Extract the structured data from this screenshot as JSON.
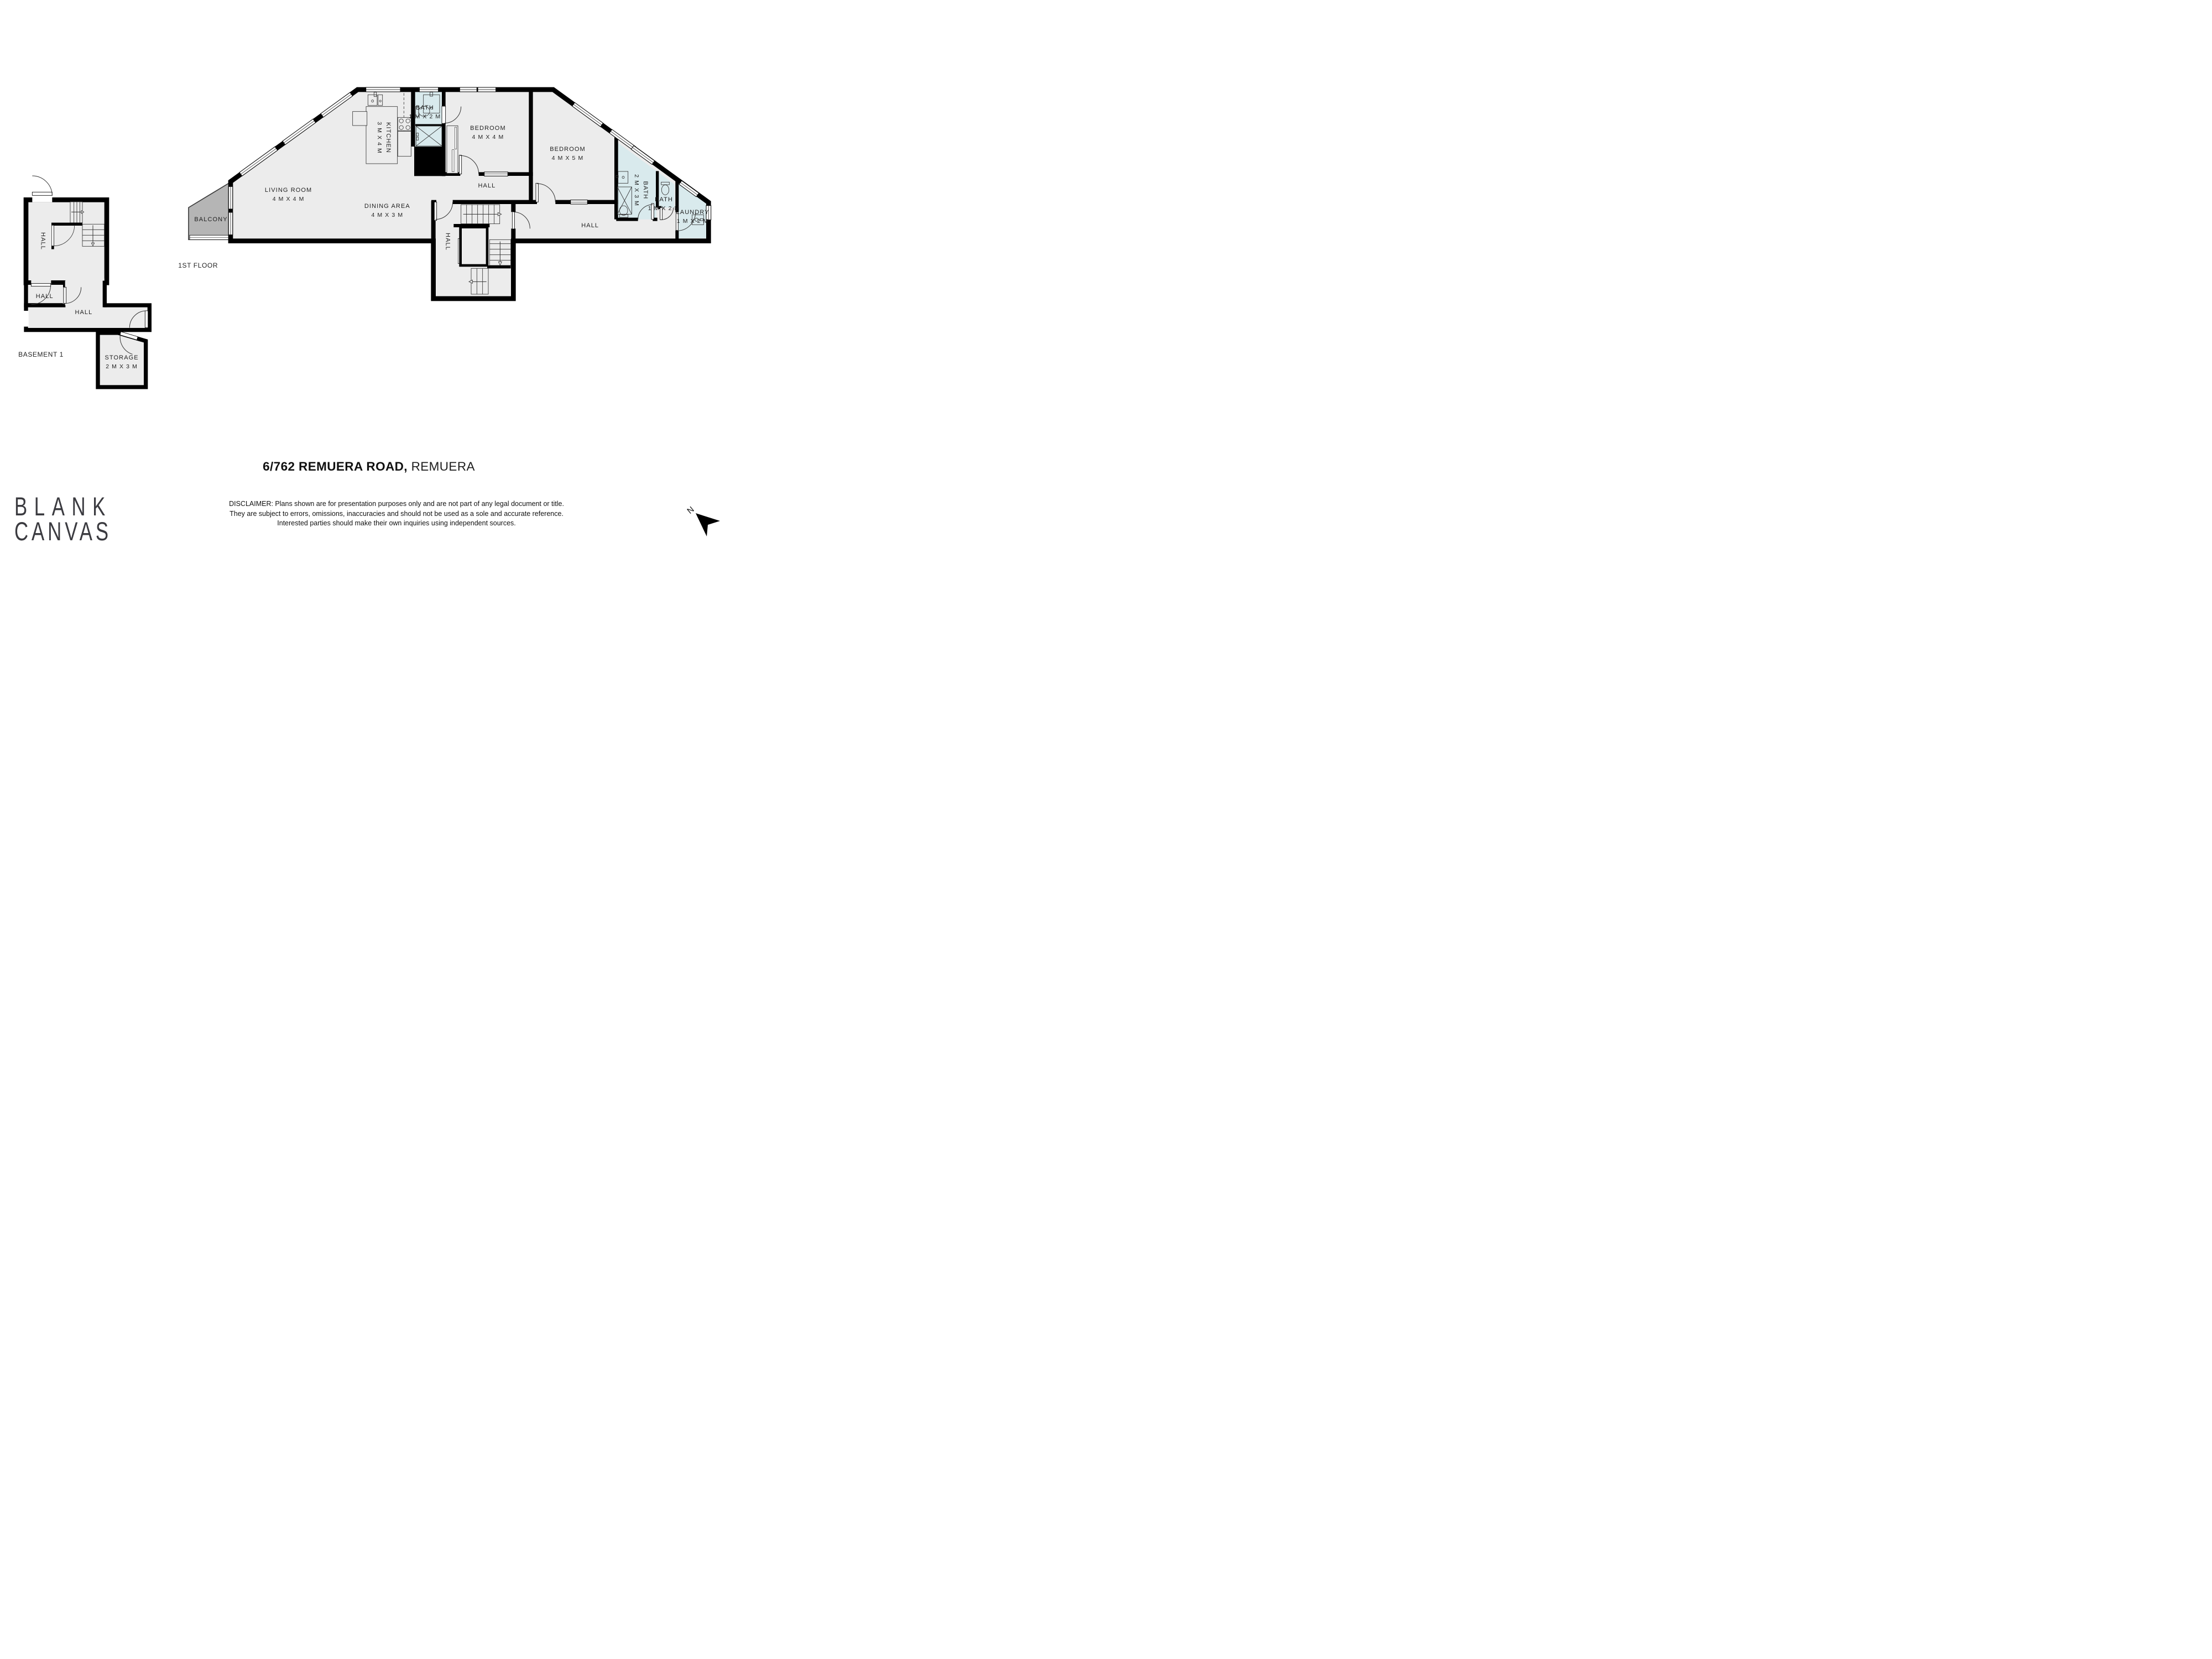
{
  "title": {
    "address_bold": "6/762 REMUERA ROAD,",
    "suburb_light": "REMUERA"
  },
  "branding": {
    "logo_line1": "BLANK",
    "logo_line2": "CANVAS"
  },
  "compass": {
    "north_label": "N",
    "icon": "north-arrow-icon"
  },
  "disclaimer": {
    "line1": "DISCLAIMER: Plans shown are for presentation purposes only and are not part of any legal document or title.",
    "line2": "They are subject to errors, omissions, inaccuracies and should not be used as a sole and accurate reference.",
    "line3": "Interested parties should make their own inquiries using independent sources."
  },
  "colors": {
    "wall": "#000000",
    "room_fill": "#ececec",
    "wet_room_fill": "#d9eaed",
    "balcony_fill": "#b5b5b5",
    "label_text": "#1f1f1f",
    "logo_text": "#3b3b40"
  },
  "floors": [
    {
      "id": "first-floor",
      "caption": "1ST FLOOR"
    },
    {
      "id": "basement-1",
      "caption": "BASEMENT 1"
    }
  ],
  "labels": [
    {
      "id": "living-room",
      "lines": [
        "LIVING ROOM",
        "4 M X 4 M"
      ],
      "x": 39.1,
      "y": 35.2,
      "rot": false
    },
    {
      "id": "dining-area",
      "lines": [
        "DINING AREA",
        "4 M X 3 M"
      ],
      "x": 52.5,
      "y": 38.1,
      "rot": false
    },
    {
      "id": "kitchen",
      "lines": [
        "KITCHEN",
        "3 M X 4 M"
      ],
      "x": 52.05,
      "y": 24.9,
      "rot": true
    },
    {
      "id": "bath-top",
      "lines": [
        "BATH",
        "1 M X 2 M"
      ],
      "x": 57.6,
      "y": 20.3,
      "rot": false
    },
    {
      "id": "bedroom-1",
      "lines": [
        "BEDROOM",
        "4 M X 4 M"
      ],
      "x": 66.15,
      "y": 24.0,
      "rot": false
    },
    {
      "id": "bedroom-2",
      "lines": [
        "BEDROOM",
        "4 M X 5 M"
      ],
      "x": 76.95,
      "y": 27.8,
      "rot": false
    },
    {
      "id": "hall-upper",
      "lines": [
        "HALL"
      ],
      "x": 66.0,
      "y": 33.6,
      "rot": false
    },
    {
      "id": "hall-center",
      "lines": [
        "HALL"
      ],
      "x": 60.65,
      "y": 43.7,
      "rot": true
    },
    {
      "id": "hall-lower",
      "lines": [
        "HALL"
      ],
      "x": 80.0,
      "y": 40.8,
      "rot": false
    },
    {
      "id": "bath-ensuite",
      "lines": [
        "BATH",
        "2 M X 3 M"
      ],
      "x": 86.9,
      "y": 34.4,
      "rot": true
    },
    {
      "id": "bath-small",
      "lines": [
        "BATH",
        "1 M X 2 M"
      ],
      "x": 90.0,
      "y": 36.9,
      "rot": false
    },
    {
      "id": "laundry",
      "lines": [
        "LAUNDRY",
        "1 M X 2 M"
      ],
      "x": 93.9,
      "y": 39.2,
      "rot": false
    },
    {
      "id": "balcony",
      "lines": [
        "BALCONY"
      ],
      "x": 28.6,
      "y": 39.7,
      "rot": false
    },
    {
      "id": "caption-1st-floor",
      "lines": [
        "1ST FLOOR"
      ],
      "x": 26.85,
      "y": 48.0,
      "rot": false,
      "caption": true
    },
    {
      "id": "hall-basement-top",
      "lines": [
        "HALL"
      ],
      "x": 5.75,
      "y": 43.6,
      "rot": true
    },
    {
      "id": "hall-basement-small",
      "lines": [
        "HALL"
      ],
      "x": 6.05,
      "y": 53.6,
      "rot": false
    },
    {
      "id": "hall-basement-corr",
      "lines": [
        "HALL"
      ],
      "x": 11.35,
      "y": 56.5,
      "rot": false
    },
    {
      "id": "storage",
      "lines": [
        "STORAGE",
        "2 M X 3 M"
      ],
      "x": 16.5,
      "y": 65.5,
      "rot": false
    },
    {
      "id": "caption-basement-1",
      "lines": [
        "BASEMENT 1"
      ],
      "x": 5.55,
      "y": 64.1,
      "rot": false,
      "caption": true
    }
  ]
}
